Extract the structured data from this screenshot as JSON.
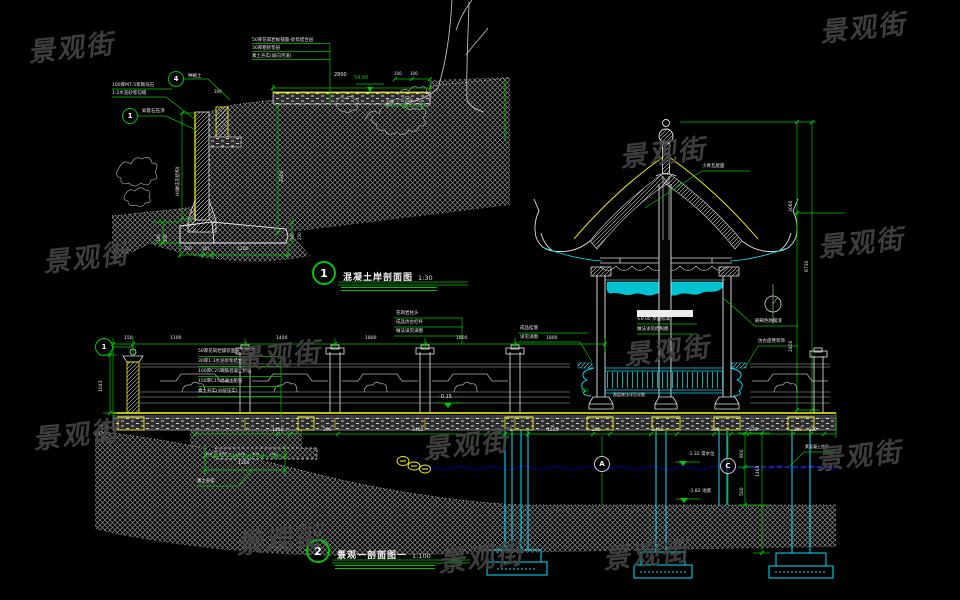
{
  "watermark": {
    "text": "景观街",
    "color": "#434343"
  },
  "colors": {
    "background": "#000000",
    "dim_green": "#00c800",
    "structure_cyan": "#00e5ff",
    "accent_yellow": "#ffff00",
    "line_white": "#e8e8e8",
    "hatch_gray": "#8e8e8e",
    "water_dark_blue": "#00008b",
    "water_bright_blue": "#2f55ff"
  },
  "detail1": {
    "number": "1",
    "title": "混凝土岸剖面图",
    "scale": "1:30"
  },
  "detail2": {
    "number": "2",
    "title": "景观一剖面图一",
    "scale": "1:100"
  },
  "watermark_positions": [
    {
      "x": 822,
      "y": 6
    },
    {
      "x": 30,
      "y": 26
    },
    {
      "x": 45,
      "y": 236
    },
    {
      "x": 622,
      "y": 131
    },
    {
      "x": 820,
      "y": 221
    },
    {
      "x": 237,
      "y": 334
    },
    {
      "x": 626,
      "y": 329
    },
    {
      "x": 35,
      "y": 413
    },
    {
      "x": 425,
      "y": 423
    },
    {
      "x": 818,
      "y": 434
    },
    {
      "x": 238,
      "y": 518
    },
    {
      "x": 605,
      "y": 533
    },
    {
      "x": 440,
      "y": 536
    }
  ],
  "markers": [
    {
      "label": "4",
      "x": 176,
      "y": 79,
      "kind": "detail"
    },
    {
      "label": "1",
      "x": 130,
      "y": 116,
      "kind": "detail"
    },
    {
      "label": "1",
      "x": 104,
      "y": 347,
      "kind": "sec"
    },
    {
      "label": "A",
      "x": 602,
      "y": 464,
      "kind": "axis"
    },
    {
      "label": "C",
      "x": 728,
      "y": 466,
      "kind": "axis"
    }
  ],
  "annotations": [
    {
      "t": "50厚花岗岩板铺面-砂浆结合层",
      "x": 252,
      "y": 38
    },
    {
      "t": "30厚粗砂垫层",
      "x": 252,
      "y": 46
    },
    {
      "t": "素土夯实(坡向河道)",
      "x": 252,
      "y": 54
    },
    {
      "t": "种植土",
      "x": 188,
      "y": 74
    },
    {
      "t": "100厚M7.5浆砌块石",
      "x": 112,
      "y": 83
    },
    {
      "t": "1:2水泥砂浆勾缝",
      "x": 112,
      "y": 91
    },
    {
      "t": "如意石压顶",
      "x": 142,
      "y": 109
    },
    {
      "t": "300",
      "x": 214,
      "y": 90,
      "s": 4
    },
    {
      "t": "2800",
      "x": 334,
      "y": 73,
      "s": 5
    },
    {
      "t": "100",
      "x": 394,
      "y": 72,
      "s": 4
    },
    {
      "t": "100",
      "x": 410,
      "y": 72,
      "s": 4
    },
    {
      "t": "54.60",
      "x": 354,
      "y": 76,
      "c": "g",
      "s": 5
    },
    {
      "t": "100",
      "x": 386,
      "y": 100,
      "s": 4
    },
    {
      "t": "100",
      "x": 404,
      "y": 100,
      "s": 4
    },
    {
      "t": "H(做法见结构)",
      "x": 176,
      "y": 196,
      "r": 1
    },
    {
      "t": "2300",
      "x": 280,
      "y": 182,
      "r": 1
    },
    {
      "t": "160",
      "x": 157,
      "y": 242,
      "r": 1,
      "s": 4
    },
    {
      "t": "100",
      "x": 164,
      "y": 242,
      "r": 1,
      "s": 4
    },
    {
      "t": "350",
      "x": 291,
      "y": 240,
      "r": 1,
      "s": 4
    },
    {
      "t": "250",
      "x": 298,
      "y": 240,
      "r": 1,
      "s": 4
    },
    {
      "t": "350",
      "x": 184,
      "y": 247,
      "s": 4
    },
    {
      "t": "165",
      "x": 202,
      "y": 247,
      "s": 4
    },
    {
      "t": "1200",
      "x": 237,
      "y": 247,
      "s": 4.5
    },
    {
      "t": "小青瓦屋面",
      "x": 702,
      "y": 164
    },
    {
      "t": "3060",
      "x": 789,
      "y": 212,
      "r": 1
    },
    {
      "t": "6730",
      "x": 805,
      "y": 272,
      "r": 1
    },
    {
      "t": "2400",
      "x": 789,
      "y": 352,
      "r": 1
    },
    {
      "t": "刷褐色防腐漆",
      "x": 755,
      "y": 319
    },
    {
      "t": "仿古座凳装饰",
      "x": 758,
      "y": 339
    },
    {
      "t": "±0.00 亭面标高",
      "x": 637,
      "y": 317
    },
    {
      "t": "做法详见结构图",
      "x": 637,
      "y": 327
    },
    {
      "t": "面层做法详见详图",
      "x": 613,
      "y": 393,
      "s": 4
    },
    {
      "t": "500",
      "x": 581,
      "y": 389,
      "c": "g",
      "s": 4
    },
    {
      "t": "150",
      "x": 124,
      "y": 336
    },
    {
      "t": "1100",
      "x": 170,
      "y": 336
    },
    {
      "t": "1400",
      "x": 276,
      "y": 336
    },
    {
      "t": "1800",
      "x": 365,
      "y": 336
    },
    {
      "t": "1800",
      "x": 456,
      "y": 336
    },
    {
      "t": "1800",
      "x": 546,
      "y": 336
    },
    {
      "t": "1043",
      "x": 99,
      "y": 392,
      "r": 1
    },
    {
      "t": "50厚花岗岩铺装面层",
      "x": 198,
      "y": 349
    },
    {
      "t": "30厚1:3水泥砂浆结合层",
      "x": 198,
      "y": 359
    },
    {
      "t": "100厚C25钢筋混凝土桥板",
      "x": 198,
      "y": 369
    },
    {
      "t": "150厚C15混凝土垫层",
      "x": 198,
      "y": 379
    },
    {
      "t": "素土夯实(分层压实)",
      "x": 198,
      "y": 389
    },
    {
      "t": "花岗岩柱头",
      "x": 396,
      "y": 311
    },
    {
      "t": "成品仿古栏杆",
      "x": 396,
      "y": 320
    },
    {
      "t": "做法详见详图",
      "x": 396,
      "y": 329
    },
    {
      "t": "成品挂落",
      "x": 520,
      "y": 326
    },
    {
      "t": "详见详图",
      "x": 520,
      "y": 335
    },
    {
      "t": "-0.15",
      "x": 439,
      "y": 395,
      "s": 5
    },
    {
      "t": "1410",
      "x": 272,
      "y": 428
    },
    {
      "t": "200",
      "x": 323,
      "y": 428
    },
    {
      "t": "3465",
      "x": 412,
      "y": 428
    },
    {
      "t": "100",
      "x": 504,
      "y": 428,
      "s": 4
    },
    {
      "t": "1525",
      "x": 547,
      "y": 428
    },
    {
      "t": "200",
      "x": 592,
      "y": 428
    },
    {
      "t": "2400",
      "x": 652,
      "y": 428
    },
    {
      "t": "200",
      "x": 711,
      "y": 428
    },
    {
      "t": "270",
      "x": 749,
      "y": 428
    },
    {
      "t": "200",
      "x": 794,
      "y": 428,
      "s": 4
    },
    {
      "t": "200",
      "x": 809,
      "y": 428,
      "s": 4
    },
    {
      "t": "100",
      "x": 205,
      "y": 452,
      "s": 3.8
    },
    {
      "t": "470",
      "x": 219,
      "y": 452,
      "s": 3.8
    },
    {
      "t": "200",
      "x": 238,
      "y": 452,
      "s": 3.8
    },
    {
      "t": "400",
      "x": 252,
      "y": 452,
      "s": 3.8
    },
    {
      "t": "130",
      "x": 269,
      "y": 452,
      "s": 3.8
    },
    {
      "t": "1300",
      "x": 238,
      "y": 461,
      "s": 4.5
    },
    {
      "t": "素土夯实",
      "x": 197,
      "y": 479
    },
    {
      "t": "-1.32 常水位",
      "x": 688,
      "y": 452
    },
    {
      "t": "-1.82 池底",
      "x": 689,
      "y": 489
    },
    {
      "t": "800",
      "x": 740,
      "y": 458,
      "r": 1
    },
    {
      "t": "1463",
      "x": 756,
      "y": 477,
      "r": 1
    },
    {
      "t": "500",
      "x": 740,
      "y": 496,
      "r": 1
    },
    {
      "t": "素混凝土垫层",
      "x": 805,
      "y": 445,
      "s": 4
    }
  ]
}
